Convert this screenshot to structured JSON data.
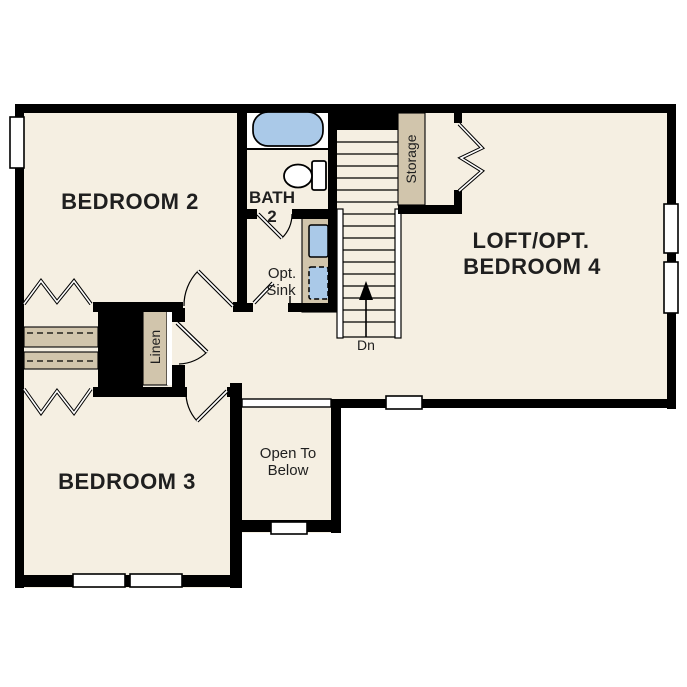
{
  "plan": {
    "title": "second-floor-plan",
    "rooms": {
      "bedroom2": "BEDROOM 2",
      "bedroom3": "BEDROOM 3",
      "loft_line1": "LOFT/OPT.",
      "loft_line2": "BEDROOM 4",
      "bath_line1": "BATH",
      "bath_line2": "2"
    },
    "annotations": {
      "opt_sink_line1": "Opt.",
      "opt_sink_line2": "Sink",
      "stairs_direction": "Dn",
      "open_below_line1": "Open To",
      "open_below_line2": "Below",
      "storage": "Storage",
      "linen": "Linen"
    },
    "colors": {
      "background": "#ffffff",
      "floor": "#f5efe2",
      "wall": "#000000",
      "casework_tan": "#d1c5ac",
      "fixture_blue": "#aac9e8",
      "text": "#1f1f1f"
    }
  }
}
